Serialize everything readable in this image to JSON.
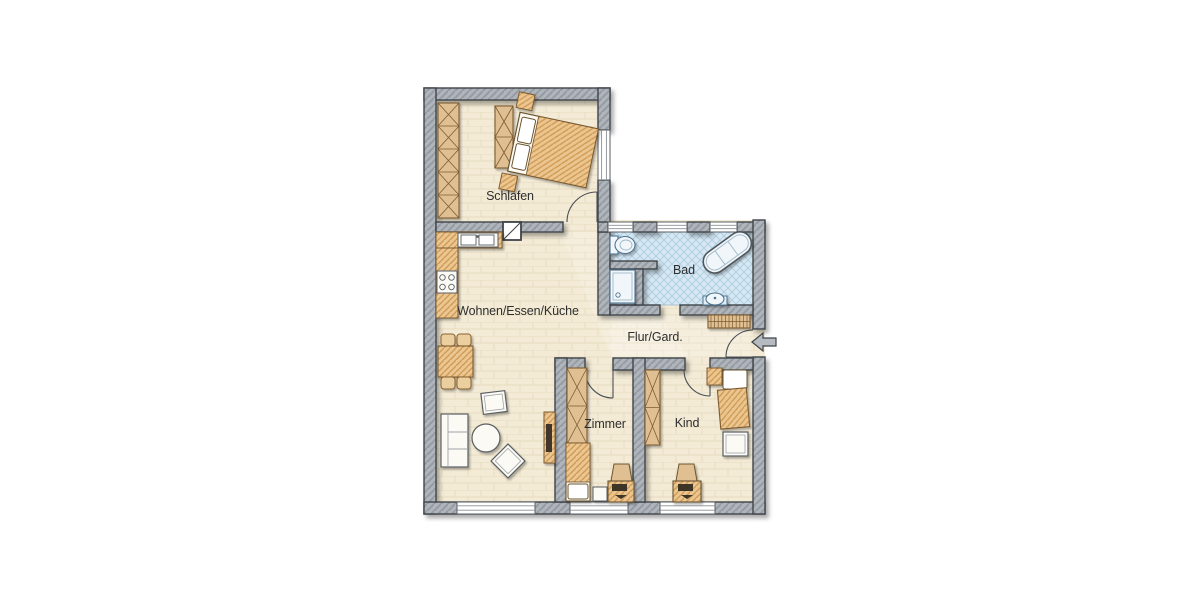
{
  "floorplan": {
    "type": "apartment-floor-plan",
    "rooms": [
      {
        "id": "schlafen",
        "label": "Schlafen"
      },
      {
        "id": "bad",
        "label": "Bad"
      },
      {
        "id": "wohnen",
        "label": "Wohnen/Essen/Küche"
      },
      {
        "id": "flur",
        "label": "Flur/Gard."
      },
      {
        "id": "zimmer",
        "label": "Zimmer"
      },
      {
        "id": "kind",
        "label": "Kind"
      }
    ],
    "icons": {
      "entry_arrow": "left-arrow-icon"
    },
    "colors": {
      "background": "#ffffff",
      "floor": "#f3ebd6",
      "floor_lines": "#e2d6b8",
      "bath_floor": "#d7e8f3",
      "bath_lines": "#a9cadf",
      "wall_fill": "#afb4bb",
      "wall_hatch": "#929archive",
      "wall_outline": "#3f444a",
      "wood_fill": "#ecc690",
      "wood_hatch": "#cf9a55",
      "wardrobe_fill": "#e0c093",
      "wood_outline": "#7d5c33",
      "fixture_fill": "#f0f6fa",
      "fixture_outline": "#4f7590",
      "label_text": "#2e2e2e"
    }
  }
}
